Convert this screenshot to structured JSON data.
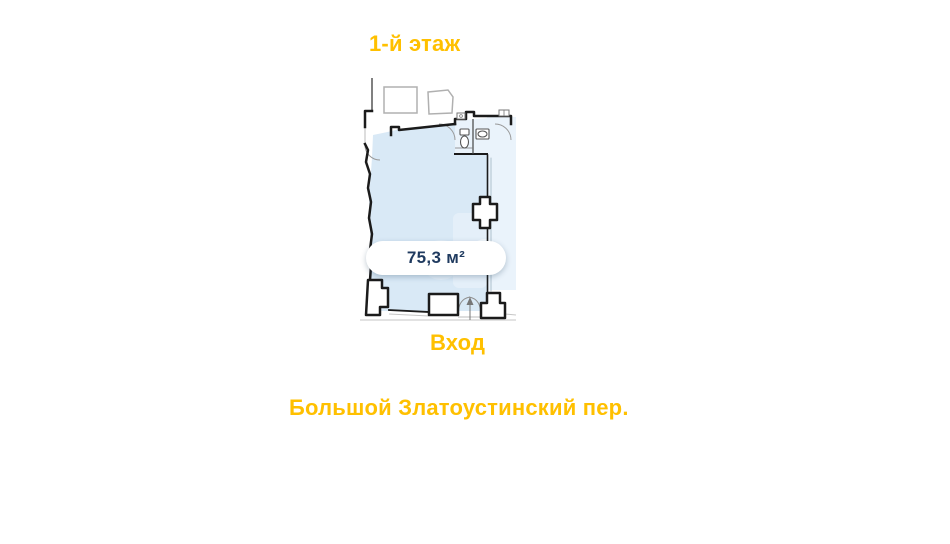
{
  "title": {
    "text": "1-й этаж"
  },
  "plan": {
    "area_label": "75,3 м²",
    "entrance_label": "Вход",
    "street_label": "Большой Златоустинский пер."
  },
  "colors": {
    "accent": "#FFC000",
    "area_text": "#1F3A5F",
    "room_fill": "#D9E9F6",
    "adjacent_fill": "#EAF3FB",
    "wall": "#1B1B1B",
    "neighbor_outline": "#B0B0B0",
    "background": "#FFFFFF"
  }
}
